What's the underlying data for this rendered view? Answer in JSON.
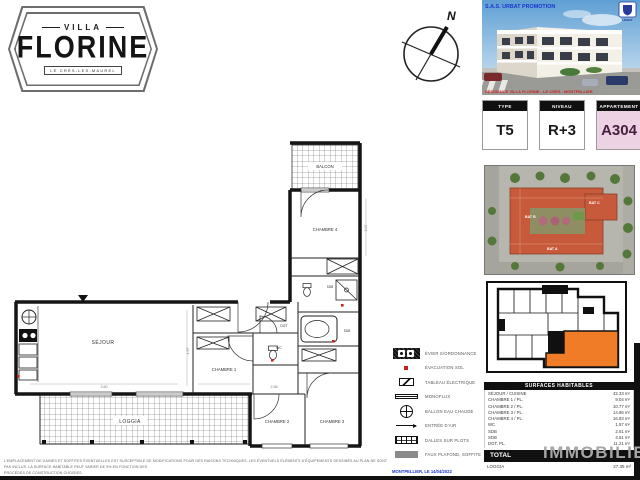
{
  "logo": {
    "villa": "VILLA",
    "name": "FLORINE",
    "subtitle": "LE CRÈS-LES-MAUREL"
  },
  "compass": {
    "north": "N"
  },
  "render": {
    "developer": "S.A.S. URBAT PROMOTION",
    "brand": "URBAT",
    "caption": "RÉSIDENCE VILLA FLORINE - LE CRÈS - MONTPELLIER"
  },
  "info_boxes": {
    "type": {
      "label": "TYPE",
      "value": "T5"
    },
    "niveau": {
      "label": "NIVEAU",
      "value": "R+3"
    },
    "appartement": {
      "label": "APPARTEMENT",
      "value": "A304"
    }
  },
  "site_plan": {
    "bat_a": "BAT A",
    "bat_b": "BAT B",
    "bat_c": "BAT C"
  },
  "plan": {
    "rooms": {
      "sejour": "SÉJOUR",
      "chambre1": "CHAMBRE 1",
      "chambre2": "CHAMBRE 2",
      "chambre3": "CHAMBRE 3",
      "chambre4": "CHAMBRE 4",
      "balcon": "BALCON",
      "loggia": "LOGGIA",
      "wc": "WC",
      "sdb1": "SDB",
      "sdb2": "SDB",
      "dgt": "DGT"
    },
    "dims": {
      "d1": "3.60",
      "d2": "2.58",
      "d3": "4.97",
      "d4": "3.07"
    }
  },
  "legend": {
    "items": [
      {
        "label": "ÉVIER S/ORDONNANCE"
      },
      {
        "label": "ÉVACUATION SOL"
      },
      {
        "label": "TABLEAU ÉLECTRIQUE"
      },
      {
        "label": "MONOFLUX"
      },
      {
        "label": "BALLON EAU CHAUDE"
      },
      {
        "label": "ENTRÉE D'AIR"
      },
      {
        "label": "DALLES SUR PLOTS"
      },
      {
        "label": "FAUX PLAFOND, SOFFITE"
      }
    ]
  },
  "surfaces": {
    "title": "SURFACES HABITABLES",
    "rows": [
      {
        "label": "SÉJOUR / CUISINE",
        "value": "42.33 m²"
      },
      {
        "label": "CHAMBRE 1 / PL.",
        "value": "9.04 m²"
      },
      {
        "label": "CHAMBRE 2 / PL.",
        "value": "10.77 m²"
      },
      {
        "label": "CHAMBRE 3 / PL.",
        "value": "14.86 m²"
      },
      {
        "label": "CHAMBRE 4 / PL.",
        "value": "16.83 m²"
      },
      {
        "label": "WC",
        "value": "1.57 m²"
      },
      {
        "label": "SDB",
        "value": "2.61 m²"
      },
      {
        "label": "SDB",
        "value": "4.61 m²"
      },
      {
        "label": "DGT. PL.",
        "value": "11.21 m²"
      }
    ],
    "total": {
      "label": "TOTAL",
      "value": ""
    },
    "loggia": {
      "label": "LOGGIA",
      "value": "27.35 m²"
    }
  },
  "watermark": {
    "text": "IMMOBILIER"
  },
  "footer": {
    "line1": "L'EMPLACEMENT DE GAINES ET SOFFITES ÉVENTUELLES EST SUSCEPTIBLE DE MODIFICATIONS POUR DES RAISONS TECHNIQUES. LES ÉVENTUELS ÉLÉMENTS D'ÉQUIPEMENTS DESSINÉS AU PLAN NE SONT PAS INCLUS. LA SURFACE HABITABLE PEUT VARIER DE 5% EN FONCTION DES",
    "line2": "PROCÉDÉS DE CONSTRUCTION CHOISIES.",
    "date": "MONTPELLIER, LE 14/04/2022"
  }
}
